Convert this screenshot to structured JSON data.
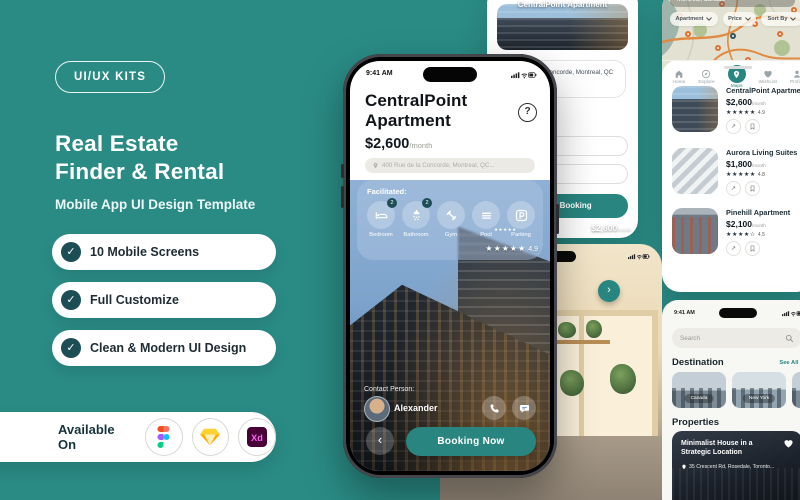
{
  "colors": {
    "background": "#2a8b85",
    "accent": "#28857f",
    "dark_badge": "#1d4e56"
  },
  "brand": {
    "badge": "UI/UX KITS",
    "title_line1": "Real Estate",
    "title_line2": "Finder & Rental",
    "subtitle": "Mobile App UI Design Template",
    "features": [
      {
        "label": "10 Mobile Screens"
      },
      {
        "label": "Full Customize"
      },
      {
        "label": "Clean & Modern UI Design"
      }
    ],
    "check_glyph": "✓",
    "available_on": {
      "label": "Available On",
      "platforms": [
        {
          "name": "Figma"
        },
        {
          "name": "Sketch"
        },
        {
          "name": "Adobe XD",
          "short": "Xd"
        }
      ]
    }
  },
  "detail_screen": {
    "status_time": "9:41 AM",
    "title_line1": "CentralPoint",
    "title_line2": "Apartment",
    "help_glyph": "?",
    "price": "$2,600",
    "price_suffix": "/month",
    "address": "400 Rue de la Concorde, Montreal, QC...",
    "facilitated_label": "Facilitated:",
    "facilities": [
      {
        "label": "Bedroom",
        "badge": "2"
      },
      {
        "label": "Bathroom",
        "badge": "2"
      },
      {
        "label": "Gym",
        "badge": ""
      },
      {
        "label": "Pool",
        "badge": ""
      },
      {
        "label": "Parking",
        "badge": ""
      }
    ],
    "stars": "★★★★★",
    "rating": "4.9",
    "contact_label": "Contact Person:",
    "contact_name": "Alexander",
    "back_glyph": "‹",
    "booking_button": "Booking Now"
  },
  "booking_screen": {
    "card_title": "CentralPoint Apartment",
    "card_stars": "★★★★★",
    "card_price": "$2,600",
    "card_price_suffix": "/month",
    "address": "400 Rue de la Concorde, Montreal, QC H3A 0H1,",
    "button_label": "Check Booking"
  },
  "map_screen": {
    "location": "Montreal, Canada",
    "filters": [
      {
        "label": "Apartment"
      },
      {
        "label": "Price"
      },
      {
        "label": "Sort By"
      }
    ],
    "action_glyph": "↗",
    "listings": [
      {
        "title": "CentralPoint Apartment",
        "price": "$2,600",
        "price_suffix": "/month",
        "stars": "★★★★★",
        "rating": "4.9"
      },
      {
        "title": "Aurora Living Suites",
        "price": "$1,800",
        "price_suffix": "/month",
        "stars": "★★★★★",
        "rating": "4.8"
      },
      {
        "title": "Pinehill Apartment",
        "price": "$2,100",
        "price_suffix": "/month",
        "stars": "★★★★☆",
        "rating": "4.5"
      }
    ],
    "nav": [
      {
        "label": "Home"
      },
      {
        "label": "Explore"
      },
      {
        "label": "Maps"
      },
      {
        "label": "WishList"
      },
      {
        "label": "Profile"
      }
    ],
    "active_nav": "Maps"
  },
  "home_screen": {
    "status_time": "9:41 AM",
    "search_placeholder": "Search",
    "destination_heading": "Destination",
    "see_all": "See All ›",
    "destinations": [
      {
        "label": "Canada"
      },
      {
        "label": "New York"
      },
      {
        "label": ""
      }
    ],
    "properties_heading": "Properties",
    "property": {
      "title": "Minimalist House in a Strategic Location",
      "address": "35 Crescent Rd, Rosedale, Toronto..."
    }
  },
  "gallery_screen": {
    "next_glyph": "›"
  }
}
